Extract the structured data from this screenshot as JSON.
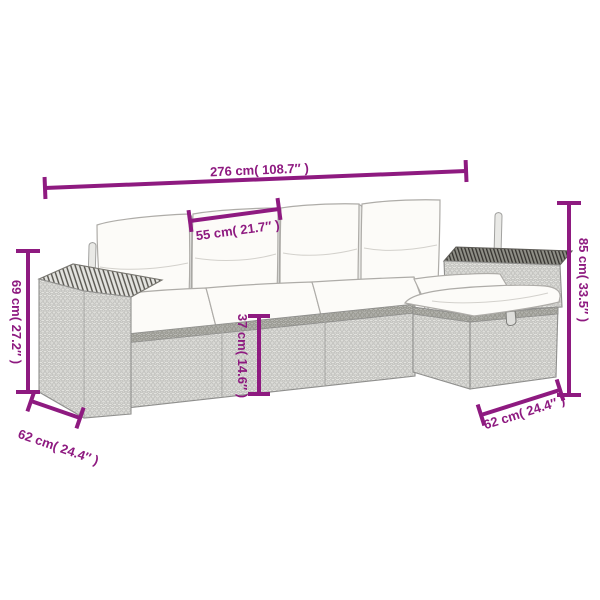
{
  "canvas": {
    "width": 600,
    "height": 600,
    "background": "#ffffff"
  },
  "palette": {
    "dimension": "#8e1a80",
    "outline": "#8f8f8d",
    "wicker_light": "#ecece9",
    "wicker_dark_band": "#c6c6c2",
    "cushion": "#fcfbf8",
    "armrest_top_dark": "#8f8f87"
  },
  "illustration": {
    "parts": [
      "left-armrest",
      "back-pillows",
      "seat-cushions",
      "right-armrest",
      "corner-seat",
      "ottoman"
    ]
  },
  "dimensions": {
    "total_width": {
      "label": "276 cm( 108.7″ )"
    },
    "seat_width": {
      "label": "55 cm( 21.7″ )"
    },
    "total_height": {
      "label": "85 cm( 33.5″ )"
    },
    "armrest_height": {
      "label": "69 cm( 27.2″ )"
    },
    "seat_height": {
      "label": "37 cm( 14.6″ )"
    },
    "ottoman_depth_left": {
      "label": "62 cm( 24.4″ )"
    },
    "ottoman_depth_right": {
      "label": "62 cm( 24.4″ )"
    }
  }
}
